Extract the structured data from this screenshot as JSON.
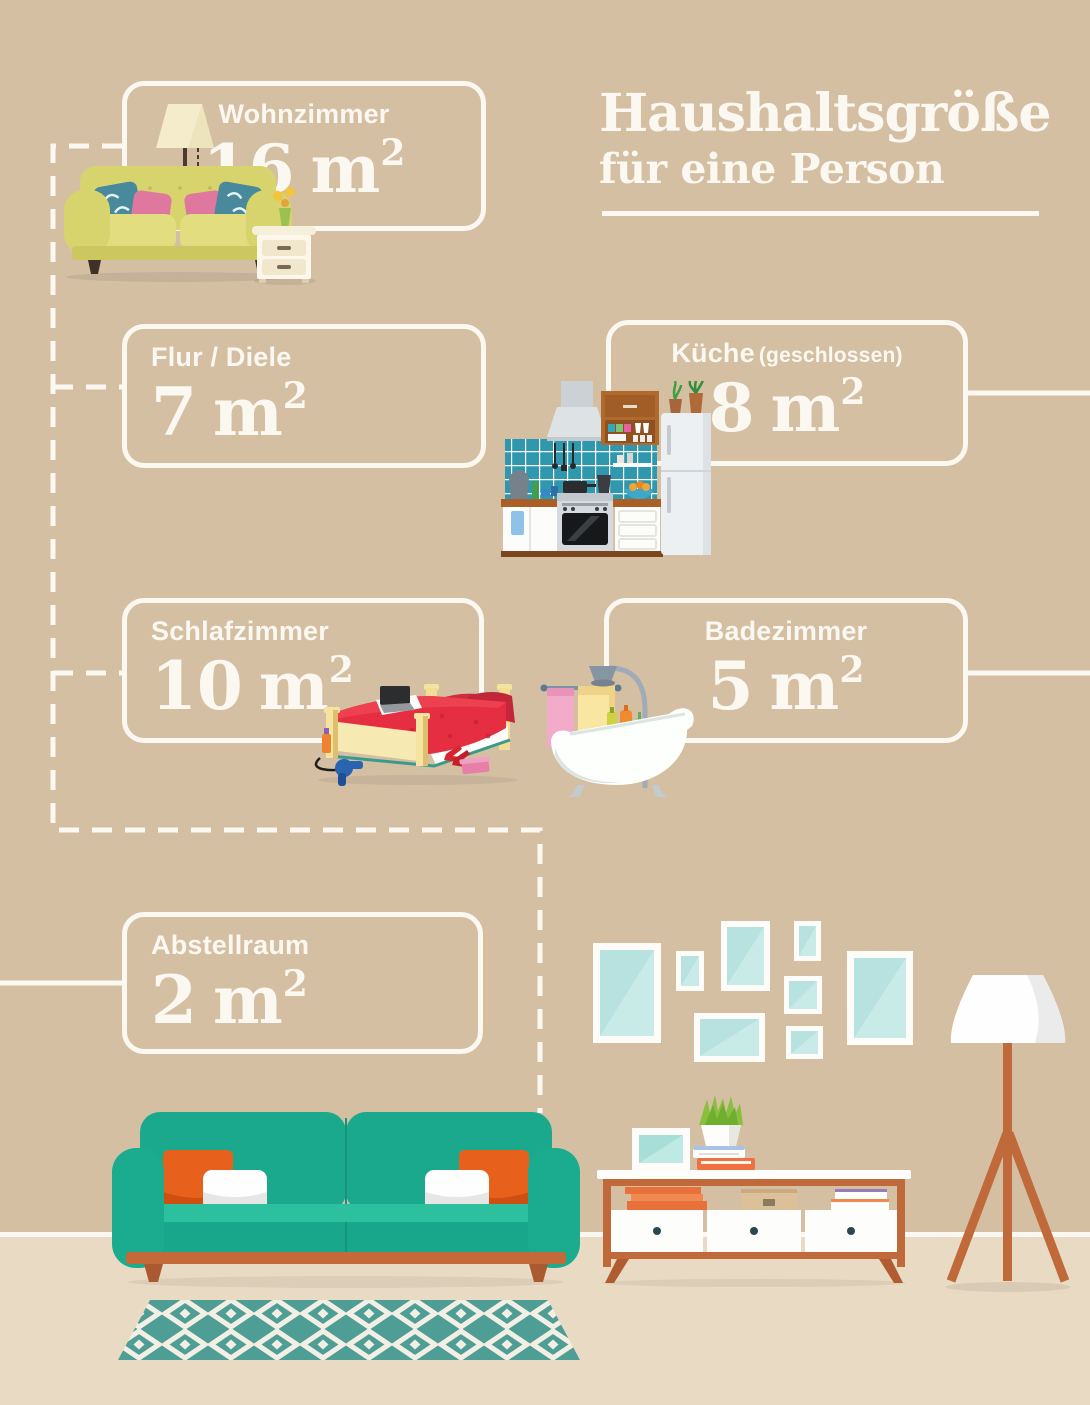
{
  "title": {
    "line1": "Haushaltsgröße",
    "line2": "für eine Person"
  },
  "rooms": [
    {
      "id": "wohnzimmer",
      "label": "Wohnzimmer",
      "value": "16",
      "unit": "m",
      "sup": "2"
    },
    {
      "id": "flur-diele",
      "label": "Flur / Diele",
      "value": "7",
      "unit": "m",
      "sup": "2"
    },
    {
      "id": "kueche",
      "label": "Küche",
      "note": "(geschlossen)",
      "value": "8",
      "unit": "m",
      "sup": "2"
    },
    {
      "id": "schlafzimmer",
      "label": "Schlafzimmer",
      "value": "10",
      "unit": "m",
      "sup": "2"
    },
    {
      "id": "badezimmer",
      "label": "Badezimmer",
      "value": "5",
      "unit": "m",
      "sup": "2"
    },
    {
      "id": "abstellraum",
      "label": "Abstellraum",
      "value": "2",
      "unit": "m",
      "sup": "2"
    }
  ],
  "icons": [
    "yellow-sofa-icon",
    "floor-lamp-icon",
    "nightstand-icon",
    "kitchen-unit-icon",
    "fridge-icon",
    "bed-icon",
    "bathtub-icon",
    "towel-rail-icon",
    "picture-frames-icon",
    "teal-sofa-icon",
    "patterned-rug-icon",
    "sideboard-icon",
    "potted-plant-icon",
    "tripod-floor-lamp-icon"
  ],
  "colors": {
    "wall": "#d4bfa3",
    "floor": "#e9dac3",
    "line_and_text": "#fbf8f1",
    "sofa_teal": "#1aa98d",
    "pillow_orange": "#e8611c",
    "wood": "#c4693a",
    "frame_glass": "#b7e2df",
    "bed_red": "#e62e42",
    "tile_teal": "#2f98ae",
    "yellow_sofa": "#d8d46d"
  }
}
